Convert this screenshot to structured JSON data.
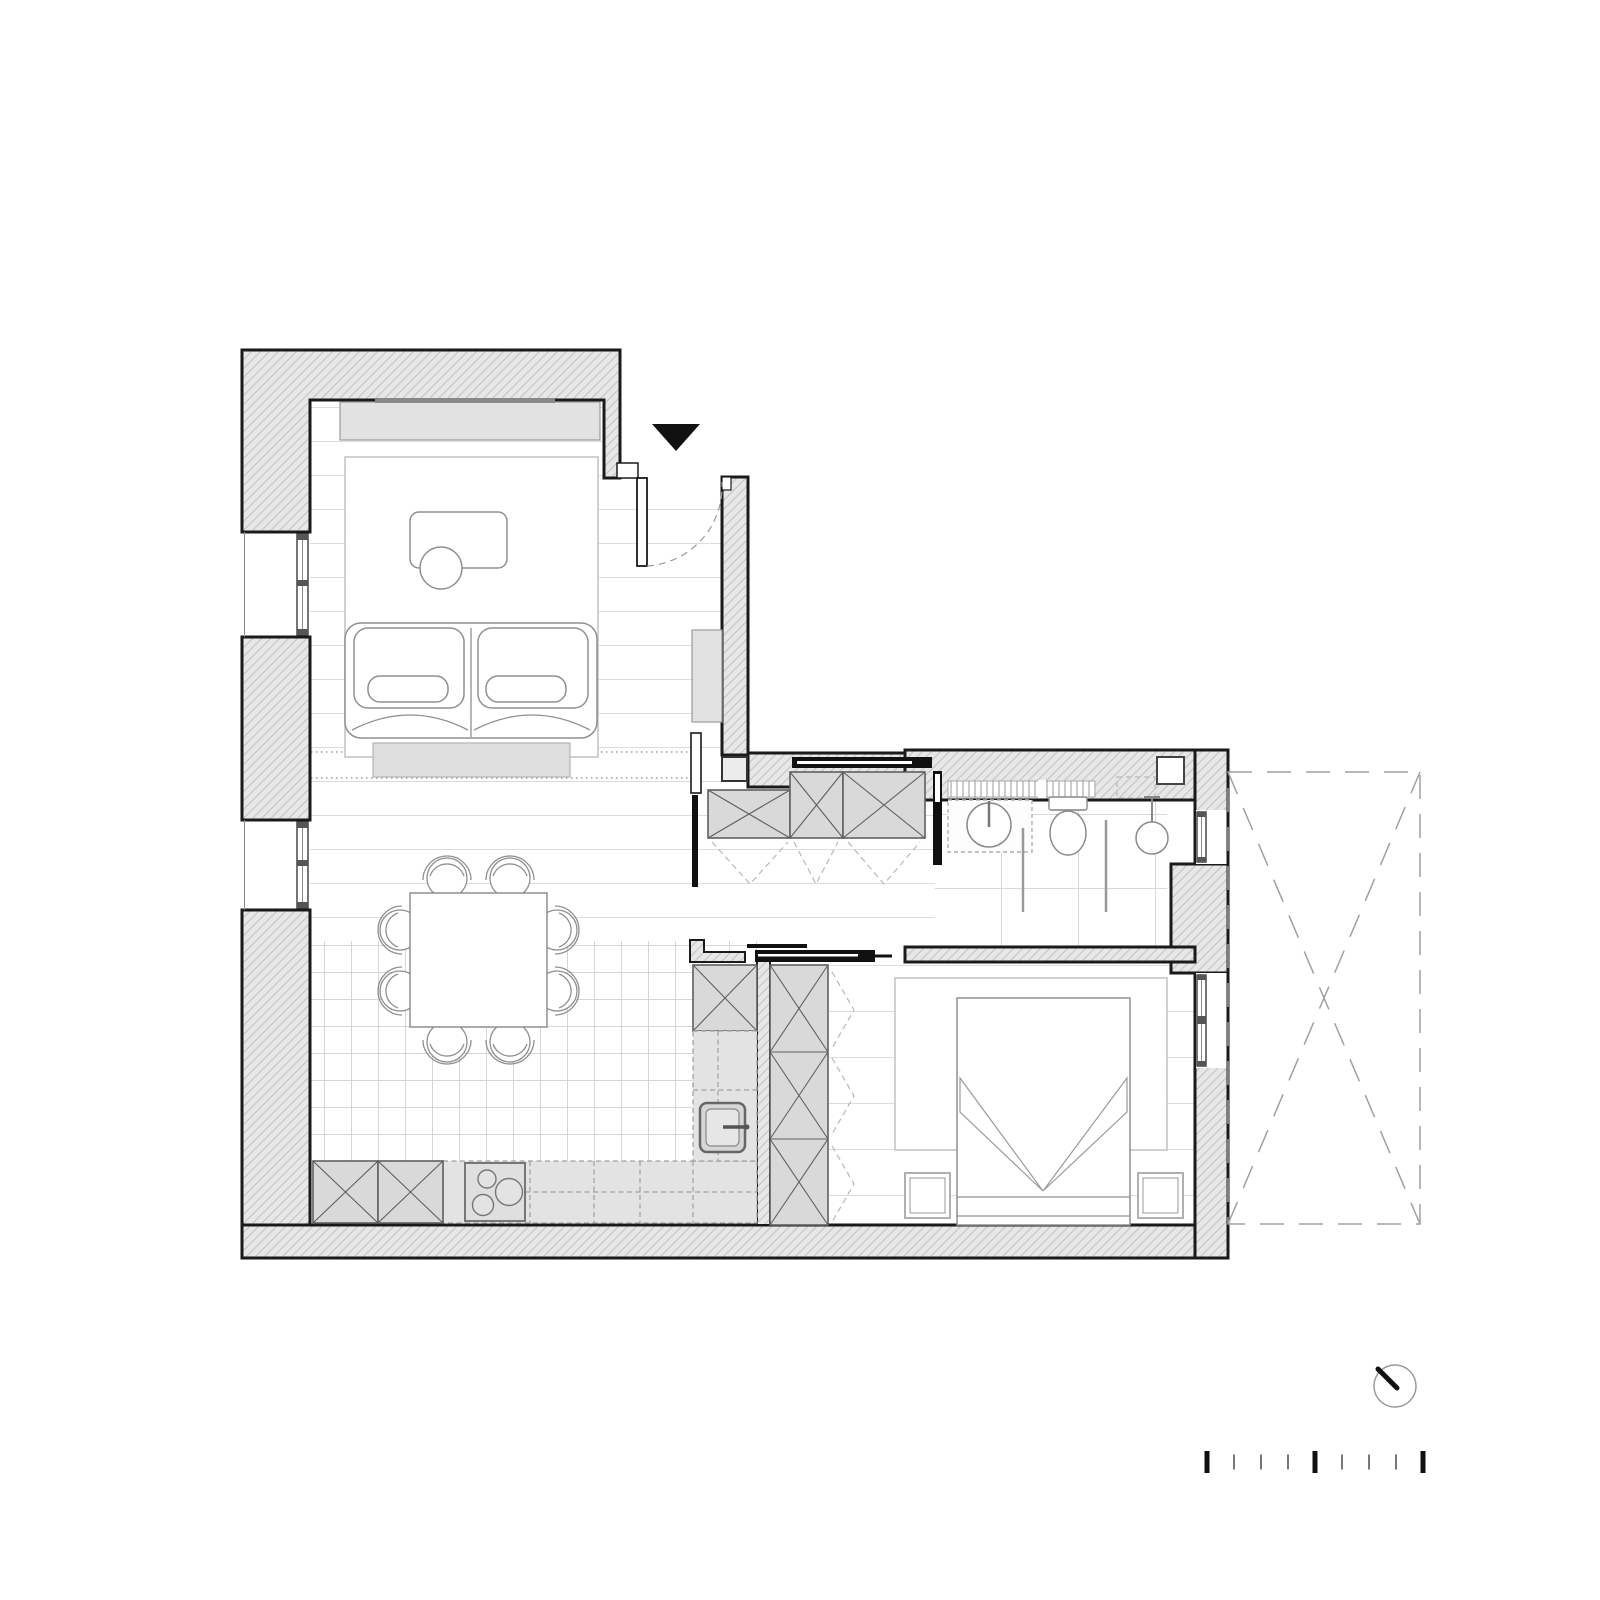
{
  "document": {
    "kind": "architectural-floor-plan",
    "background": "#ffffff",
    "canvas": {
      "width": 1600,
      "height": 1600
    }
  },
  "palette": {
    "ink": "#1a1a1a",
    "black": "#111111",
    "wall_fill": "#e7e7e7",
    "hatch_line": "#c3c3c3",
    "cabinet_fill": "#d9d9d9",
    "cabinet_stroke": "#5f5f5f",
    "counter_fill": "#e3e3e3",
    "dash_gray": "#a0a0a0",
    "furniture_stroke": "#8f8f8f",
    "rug_stroke": "#c5c5c5",
    "floor_line": "#dcdcdc",
    "tile_line": "#d6d6d6",
    "media_fill": "#e2e2e2",
    "bench_fill": "#dedede"
  },
  "rooms": [
    {
      "name": "living-room",
      "floor": "wood-planks",
      "furniture": [
        "media-console",
        "tv",
        "rug",
        "coffee-table",
        "ottoman",
        "two-seat-sofa",
        "bench"
      ]
    },
    {
      "name": "dining-area",
      "floor": "wood-planks",
      "furniture": [
        "square-table",
        "8-chairs"
      ]
    },
    {
      "name": "kitchen",
      "floor": "small-tiles",
      "furniture": [
        "tall-cabinets-x2",
        "cooktop-3-burners",
        "base-counters",
        "sink",
        "tall-cabinet-right"
      ]
    },
    {
      "name": "hallway",
      "floor": "wood-planks",
      "furniture": [
        "closet-3-sections",
        "sliding-doors",
        "column"
      ]
    },
    {
      "name": "bathroom",
      "floor": "large-tiles",
      "furniture": [
        "radiator-strip",
        "washbasin",
        "toilet",
        "glass-partitions",
        "shower",
        "duct",
        "mirror-cabinet"
      ]
    },
    {
      "name": "bedroom",
      "floor": "wood-planks",
      "furniture": [
        "wardrobe-3-sections",
        "rug",
        "double-bed",
        "nightstand-left",
        "nightstand-right",
        "sliding-door"
      ]
    },
    {
      "name": "balcony",
      "style": "dashed-outline-with-x"
    }
  ],
  "symbols": {
    "entrance_marker": {
      "icon": "filled-triangle-down",
      "color": "#111111"
    },
    "entry_door": {
      "type": "hinged",
      "swing": "dashed-quarter-arc"
    },
    "north_indicator": {
      "icon": "circle-with-needle",
      "needle_direction": "north-west"
    },
    "scale_bar": {
      "tick_count": 9,
      "ticks": [
        "major",
        "minor",
        "minor",
        "minor",
        "major",
        "minor",
        "minor",
        "minor",
        "major"
      ],
      "start_x": 1207,
      "step": 27,
      "y_top_major": 1451,
      "major_h": 22,
      "minor_h": 15,
      "major_color": "#111111",
      "minor_color": "#777777"
    }
  }
}
